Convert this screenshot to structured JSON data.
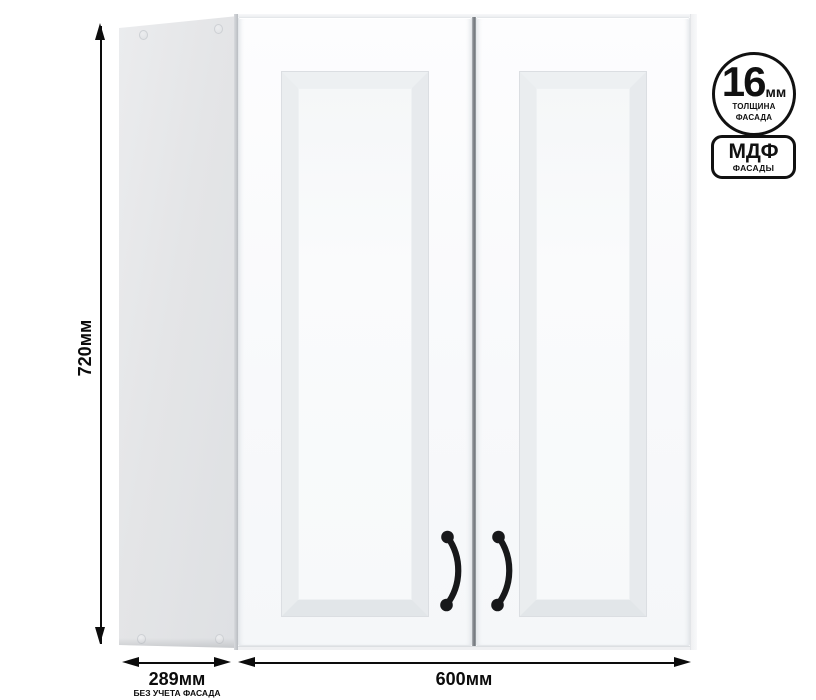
{
  "colors": {
    "background": "#ffffff",
    "dimension_ink": "#0c0c0c",
    "badge_ink": "#111111",
    "door_face": "#fafbfc",
    "side_panel": "#e3e4e6",
    "handle": "#17181a"
  },
  "badges": {
    "thickness": {
      "value": "16",
      "unit": "мм",
      "caption_line1": "ТОЛЩИНА",
      "caption_line2": "ФАСАДА"
    },
    "material": {
      "name": "МДФ",
      "caption": "ФАСАДЫ"
    }
  },
  "dimensions": {
    "height": {
      "label": "720мм"
    },
    "depth": {
      "label": "289мм",
      "note": "БЕЗ УЧЕТА ФАСАДА"
    },
    "width": {
      "label": "600мм"
    }
  }
}
